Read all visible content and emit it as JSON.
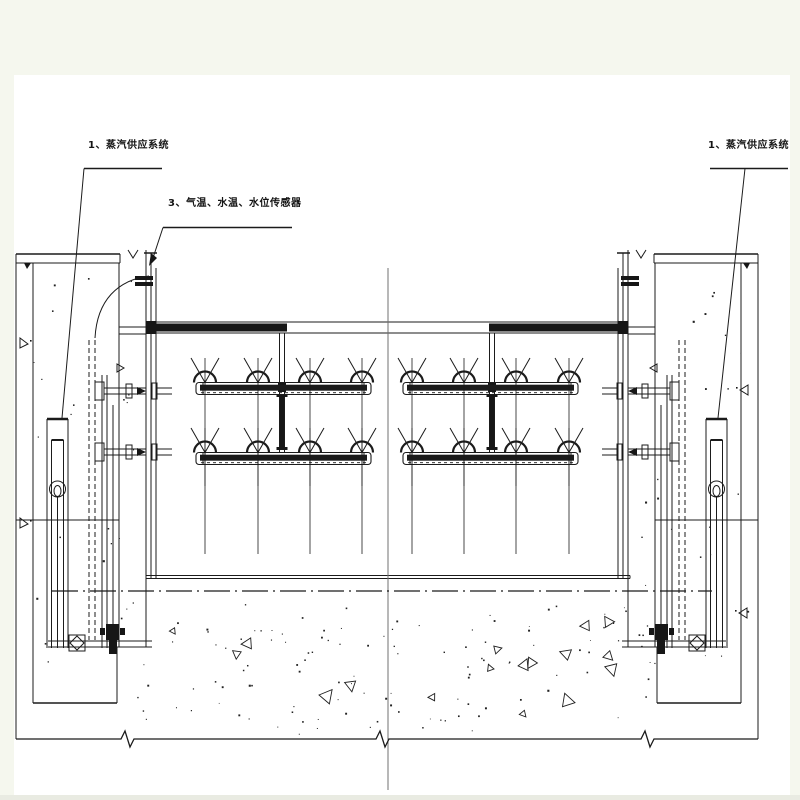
{
  "labels": {
    "steam_left": {
      "text": "1、蒸汽供应系统",
      "x": 88,
      "y": 140
    },
    "sensors": {
      "text": "3、气温、水温、水位传感器",
      "x": 168,
      "y": 198
    },
    "steam_right": {
      "text": "1、蒸汽供应系统",
      "x": 708,
      "y": 140
    }
  },
  "diagram": {
    "ink": "#1b1b1b",
    "centerline_color": "#707070",
    "paper_color": "#ffffff",
    "margin_color": "#f5f7ee",
    "bottom_band_color": "#e9ebe2",
    "mirror_x": 387,
    "sheet": {
      "x": 14,
      "y": 75,
      "w": 776,
      "h": 720
    },
    "rollers": {
      "bar_h": 12,
      "arch_r": 11,
      "rows": [
        {
          "bar_top": 382.5,
          "diag_top": 358,
          "vert_bottom": 486
        },
        {
          "bar_top": 452.5,
          "diag_top": 428,
          "vert_bottom": 554
        }
      ],
      "groups": [
        {
          "x1": 196,
          "x2": 371,
          "arches": [
            205,
            258,
            310,
            362
          ]
        },
        {
          "x1": 403,
          "x2": 578,
          "arches": [
            412,
            464,
            516,
            569
          ]
        }
      ]
    },
    "texture": {
      "seed": 13,
      "floor": {
        "x": 122,
        "y": 602,
        "w": 528,
        "h": 132,
        "dots": 120,
        "tris": 17
      },
      "piers": [
        {
          "x": 22,
          "y": 270,
          "w": 116,
          "h": 410,
          "dots": 22
        },
        {
          "x": 636,
          "y": 270,
          "w": 116,
          "h": 410,
          "dots": 22
        }
      ]
    },
    "shapes": [
      {
        "t": "r",
        "p": [
          14,
          75,
          776,
          720
        ],
        "f": "#ffffff"
      },
      {
        "t": "r",
        "p": [
          0,
          795,
          800,
          5
        ],
        "f": "#e9ebe2"
      },
      {
        "t": "l",
        "p": [
          16,
          254,
          16,
          739
        ],
        "m": 1
      },
      {
        "t": "l",
        "p": [
          33,
          263,
          33,
          703
        ],
        "m": 1
      },
      {
        "t": "l",
        "p": [
          16,
          254,
          120,
          254
        ],
        "w": 1.5,
        "m": 1
      },
      {
        "t": "l",
        "p": [
          16,
          263,
          120,
          263
        ],
        "m": 1
      },
      {
        "t": "l",
        "p": [
          120,
          254,
          120,
          263
        ],
        "m": 1
      },
      {
        "t": "pl",
        "p": [
          [
            128,
            250
          ],
          [
            133,
            258
          ],
          [
            138,
            250
          ]
        ],
        "m": 1
      },
      {
        "t": "pl",
        "p": [
          [
            24,
            263
          ],
          [
            31,
            263
          ],
          [
            27,
            269
          ]
        ],
        "f": "#161616",
        "m": 1
      },
      {
        "t": "l",
        "p": [
          146,
          250,
          146,
          647
        ],
        "m": 1
      },
      {
        "t": "l",
        "p": [
          119,
          263,
          119,
          647
        ],
        "m": 1
      },
      {
        "t": "r",
        "p": [
          135,
          276,
          18,
          4
        ],
        "f": "#161616",
        "m": 1
      },
      {
        "t": "r",
        "p": [
          135,
          282,
          18,
          4
        ],
        "f": "#161616",
        "m": 1
      },
      {
        "t": "l",
        "p": [
          151,
          253,
          151,
          578
        ],
        "m": 1
      },
      {
        "t": "l",
        "p": [
          156,
          268,
          156,
          578
        ],
        "m": 1
      },
      {
        "t": "l",
        "p": [
          144,
          253,
          157,
          253
        ],
        "w": 1.5,
        "m": 1
      },
      {
        "t": "l",
        "p": [
          16,
          520,
          119,
          520
        ],
        "m": 1
      },
      {
        "t": "l",
        "p": [
          47,
          419,
          47,
          648
        ],
        "m": 1
      },
      {
        "t": "l",
        "p": [
          68,
          419,
          68,
          648
        ],
        "m": 1
      },
      {
        "t": "l",
        "p": [
          47,
          419,
          68,
          419
        ],
        "w": 2.5,
        "m": 1
      },
      {
        "t": "l",
        "p": [
          51.5,
          440,
          51.5,
          648
        ],
        "m": 1
      },
      {
        "t": "l",
        "p": [
          63.5,
          440,
          63.5,
          648
        ],
        "m": 1
      },
      {
        "t": "l",
        "p": [
          51.5,
          440,
          63.5,
          440
        ],
        "w": 2,
        "m": 1
      },
      {
        "t": "c",
        "p": [
          57.5,
          489,
          8
        ],
        "m": 1
      },
      {
        "t": "e",
        "p": [
          57.5,
          491,
          3.5,
          5.5
        ],
        "m": 1
      },
      {
        "t": "l",
        "p": [
          57.5,
          497,
          57.5,
          648
        ],
        "m": 1
      },
      {
        "t": "l",
        "p": [
          89,
          340,
          89,
          640
        ],
        "da": "5,3",
        "m": 1
      },
      {
        "t": "l",
        "p": [
          95,
          340,
          95,
          640
        ],
        "da": "5,3",
        "m": 1
      },
      {
        "t": "l",
        "p": [
          102,
          375,
          102,
          648
        ],
        "m": 1
      },
      {
        "t": "l",
        "p": [
          107,
          375,
          107,
          648
        ],
        "m": 1
      },
      {
        "t": "l",
        "p": [
          113,
          405,
          113,
          648
        ],
        "m": 1
      },
      {
        "t": "r",
        "p": [
          95,
          382,
          9,
          18
        ],
        "m": 1
      },
      {
        "t": "l",
        "p": [
          104,
          388,
          146,
          388
        ],
        "m": 1
      },
      {
        "t": "l",
        "p": [
          104,
          394,
          146,
          394
        ],
        "m": 1
      },
      {
        "t": "r",
        "p": [
          126,
          384,
          6,
          14
        ],
        "m": 1
      },
      {
        "t": "pl",
        "p": [
          [
            137,
            387
          ],
          [
            146,
            391
          ],
          [
            137,
            395
          ]
        ],
        "f": "#161616",
        "m": 1
      },
      {
        "t": "r",
        "p": [
          152,
          383,
          5,
          16
        ],
        "m": 1
      },
      {
        "t": "l",
        "p": [
          157,
          388,
          172,
          388
        ],
        "m": 1
      },
      {
        "t": "l",
        "p": [
          157,
          394,
          172,
          394
        ],
        "m": 1
      },
      {
        "t": "r",
        "p": [
          95,
          443,
          9,
          18
        ],
        "m": 1
      },
      {
        "t": "l",
        "p": [
          104,
          449,
          146,
          449
        ],
        "m": 1
      },
      {
        "t": "l",
        "p": [
          104,
          455,
          146,
          455
        ],
        "m": 1
      },
      {
        "t": "r",
        "p": [
          126,
          445,
          6,
          14
        ],
        "m": 1
      },
      {
        "t": "pl",
        "p": [
          [
            137,
            448
          ],
          [
            146,
            452
          ],
          [
            137,
            456
          ]
        ],
        "f": "#161616",
        "m": 1
      },
      {
        "t": "r",
        "p": [
          152,
          444,
          5,
          16
        ],
        "m": 1
      },
      {
        "t": "l",
        "p": [
          157,
          449,
          172,
          449
        ],
        "m": 1
      },
      {
        "t": "l",
        "p": [
          157,
          455,
          172,
          455
        ],
        "m": 1
      },
      {
        "t": "pl",
        "p": [
          [
            117,
            364
          ],
          [
            117,
            372
          ],
          [
            124,
            368
          ]
        ],
        "close": 1,
        "m": 1
      },
      {
        "t": "l",
        "p": [
          48,
          641,
          152,
          641
        ],
        "m": 1
      },
      {
        "t": "l",
        "p": [
          48,
          647,
          152,
          647
        ],
        "m": 1
      },
      {
        "t": "r",
        "p": [
          69,
          635,
          16,
          16
        ],
        "m": 1
      },
      {
        "t": "pl",
        "p": [
          [
            77,
            636
          ],
          [
            84,
            643
          ],
          [
            77,
            650
          ],
          [
            70,
            643
          ]
        ],
        "close": 1,
        "m": 1
      },
      {
        "t": "r",
        "p": [
          106,
          624,
          13,
          16
        ],
        "f": "#161616",
        "m": 1
      },
      {
        "t": "r",
        "p": [
          109,
          640,
          8,
          14
        ],
        "f": "#161616",
        "m": 1
      },
      {
        "t": "r",
        "p": [
          100,
          628,
          5,
          7
        ],
        "f": "#161616",
        "m": 1
      },
      {
        "t": "r",
        "p": [
          120,
          628,
          5,
          7
        ],
        "f": "#161616",
        "m": 1
      },
      {
        "t": "l",
        "p": [
          33,
          703,
          117,
          703
        ],
        "w": 1.4,
        "m": 1
      },
      {
        "t": "l",
        "p": [
          117,
          647,
          117,
          703
        ],
        "m": 1
      },
      {
        "t": "l",
        "p": [
          119,
          327,
          146,
          327
        ],
        "m": 1
      },
      {
        "t": "l",
        "p": [
          119,
          334,
          146,
          334
        ],
        "m": 1
      },
      {
        "t": "l",
        "p": [
          150,
          322,
          628,
          322
        ]
      },
      {
        "t": "l",
        "p": [
          150,
          333,
          628,
          333
        ]
      },
      {
        "t": "r",
        "p": [
          150,
          323.5,
          137,
          8
        ],
        "f": "#161616"
      },
      {
        "t": "r",
        "p": [
          489,
          323.5,
          139,
          8
        ],
        "f": "#161616"
      },
      {
        "t": "r",
        "p": [
          146,
          321,
          10,
          13
        ],
        "f": "#161616"
      },
      {
        "t": "r",
        "p": [
          618,
          321,
          10,
          13
        ],
        "f": "#161616"
      },
      {
        "t": "l",
        "p": [
          279.5,
          333,
          279.5,
          452
        ],
        "m": 1
      },
      {
        "t": "l",
        "p": [
          284.5,
          333,
          284.5,
          452
        ],
        "m": 1
      },
      {
        "t": "r",
        "p": [
          280,
          396,
          4,
          54
        ],
        "f": "#161616",
        "m": 1
      },
      {
        "t": "r",
        "p": [
          276.5,
          394,
          11,
          3
        ],
        "f": "#161616",
        "m": 1
      },
      {
        "t": "r",
        "p": [
          276.5,
          447,
          11,
          3
        ],
        "f": "#161616",
        "m": 1
      },
      {
        "t": "r",
        "p": [
          278,
          383,
          8,
          9
        ],
        "f": "#161616",
        "m": 1
      },
      {
        "t": "l",
        "p": [
          146,
          575.5,
          630,
          575.5
        ]
      },
      {
        "t": "l",
        "p": [
          146,
          578.5,
          630,
          578.5
        ]
      },
      {
        "t": "l",
        "p": [
          630,
          575.5,
          630,
          578.5
        ]
      },
      {
        "t": "l",
        "p": [
          388,
          268,
          388,
          790
        ],
        "c": "#707070"
      },
      {
        "t": "l",
        "p": [
          52,
          591,
          712,
          591
        ],
        "w": 1.3,
        "da": "26,5,2,5"
      },
      {
        "t": "pl",
        "p": [
          [
            16,
            739
          ],
          [
            121,
            739
          ],
          [
            125,
            731
          ],
          [
            130,
            747
          ],
          [
            134,
            739
          ],
          [
            376,
            739
          ],
          [
            380,
            731
          ],
          [
            385,
            747
          ],
          [
            389,
            739
          ],
          [
            641,
            739
          ],
          [
            645,
            731
          ],
          [
            650,
            747
          ],
          [
            654,
            739
          ],
          [
            758,
            739
          ]
        ],
        "w": 1.3
      },
      {
        "t": "l",
        "p": [
          84,
          168.5,
          162,
          168.5
        ],
        "w": 1.4
      },
      {
        "t": "l",
        "p": [
          84,
          168.5,
          62,
          418
        ]
      },
      {
        "t": "l",
        "p": [
          163,
          227.5,
          292,
          227.5
        ],
        "w": 1.4
      },
      {
        "t": "l",
        "p": [
          163,
          227.5,
          152,
          261
        ]
      },
      {
        "t": "pl",
        "p": [
          [
            149,
            266
          ],
          [
            157,
            258
          ],
          [
            151,
            253
          ]
        ],
        "f": "#161616",
        "close": 1
      },
      {
        "t": "l",
        "p": [
          710,
          168.5,
          788,
          168.5
        ],
        "w": 1.4
      },
      {
        "t": "l",
        "p": [
          745,
          168.5,
          718,
          418
        ]
      },
      {
        "t": "pa",
        "p": "M149,276 C118,280 97,300 95,338"
      },
      {
        "t": "pl",
        "p": [
          [
            20,
            338
          ],
          [
            20,
            348
          ],
          [
            28,
            344
          ]
        ],
        "close": 1
      },
      {
        "t": "r",
        "p": [
          30,
          340,
          1.6,
          1.6
        ],
        "f": "#161616"
      },
      {
        "t": "pl",
        "p": [
          [
            20,
            518
          ],
          [
            20,
            528
          ],
          [
            28,
            524
          ]
        ],
        "close": 1
      },
      {
        "t": "r",
        "p": [
          30,
          520,
          1.6,
          1.6
        ],
        "f": "#161616"
      },
      {
        "t": "pl",
        "p": [
          [
            748,
            385
          ],
          [
            748,
            395
          ],
          [
            740,
            390
          ]
        ],
        "close": 1
      },
      {
        "t": "r",
        "p": [
          736,
          387,
          1.6,
          1.6
        ],
        "f": "#161616"
      },
      {
        "t": "pl",
        "p": [
          [
            747,
            608
          ],
          [
            747,
            618
          ],
          [
            739,
            613
          ]
        ],
        "close": 1
      },
      {
        "t": "r",
        "p": [
          735,
          610,
          1.6,
          1.6
        ],
        "f": "#161616"
      }
    ]
  }
}
